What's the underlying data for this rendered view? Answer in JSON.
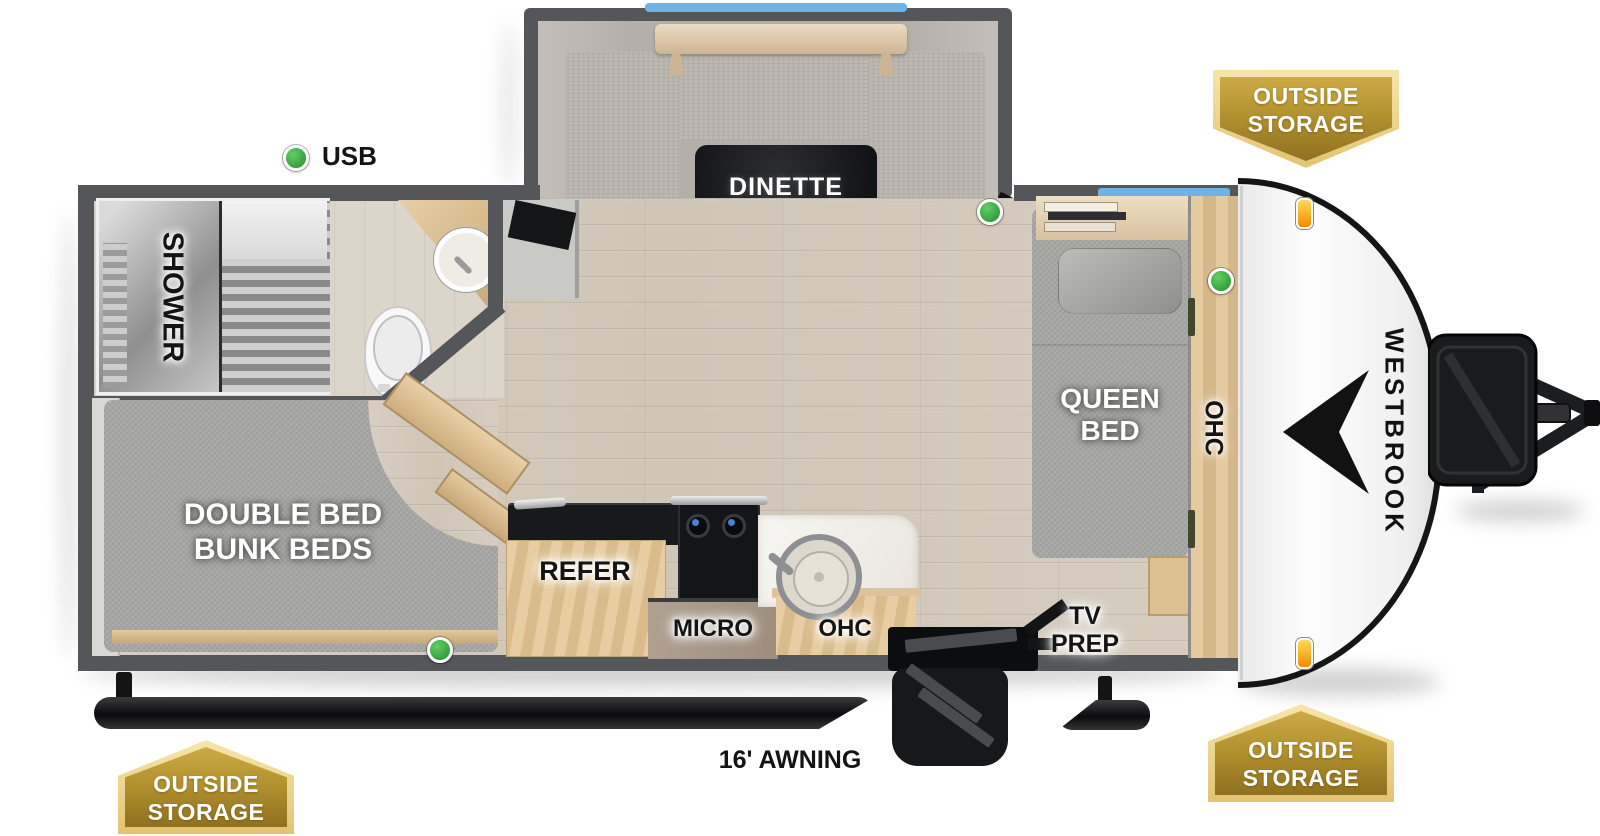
{
  "page": {
    "type": "travel-trailer-floorplan",
    "background": "#ffffff"
  },
  "brand": {
    "logo_text": "WESTBROOK"
  },
  "callouts": {
    "usb_label": "USB",
    "awning_label": "16' AWNING"
  },
  "rooms": {
    "dinette": {
      "label": "DINETTE"
    },
    "shower": {
      "label": "SHOWER"
    },
    "bunk": {
      "line1": "DOUBLE BED",
      "line2": "BUNK BEDS"
    },
    "queen": {
      "line1": "QUEEN",
      "line2": "BED"
    },
    "bedroom_ohc": {
      "label": "OHC"
    },
    "tv_prep": {
      "line1": "TV",
      "line2": "PREP"
    },
    "refer": {
      "label": "REFER"
    },
    "micro": {
      "label": "MICRO"
    },
    "kitchen_ohc": {
      "label": "OHC"
    }
  },
  "badges": {
    "top_right": {
      "line1": "OUTSIDE",
      "line2": "STORAGE"
    },
    "bottom_right": {
      "line1": "OUTSIDE",
      "line2": "STORAGE"
    },
    "bottom_left": {
      "line1": "OUTSIDE",
      "line2": "STORAGE"
    }
  },
  "indicators": {
    "green_dot_meaning": "USB",
    "green_dot_count": 4
  },
  "colors": {
    "wall_gray": "#55565a",
    "floor_wood": "#d3cabd",
    "mattress_gray": "#a7a7a5",
    "cabinet_wood": "#dec094",
    "window_blue": "#6fb3e4",
    "indicator_green": "#3cae49",
    "badge_gold": "#b3922f",
    "badge_gold_trim": "#f3dd9b",
    "table_black": "#17181b",
    "front_cap_white": "#f4f4f4"
  }
}
